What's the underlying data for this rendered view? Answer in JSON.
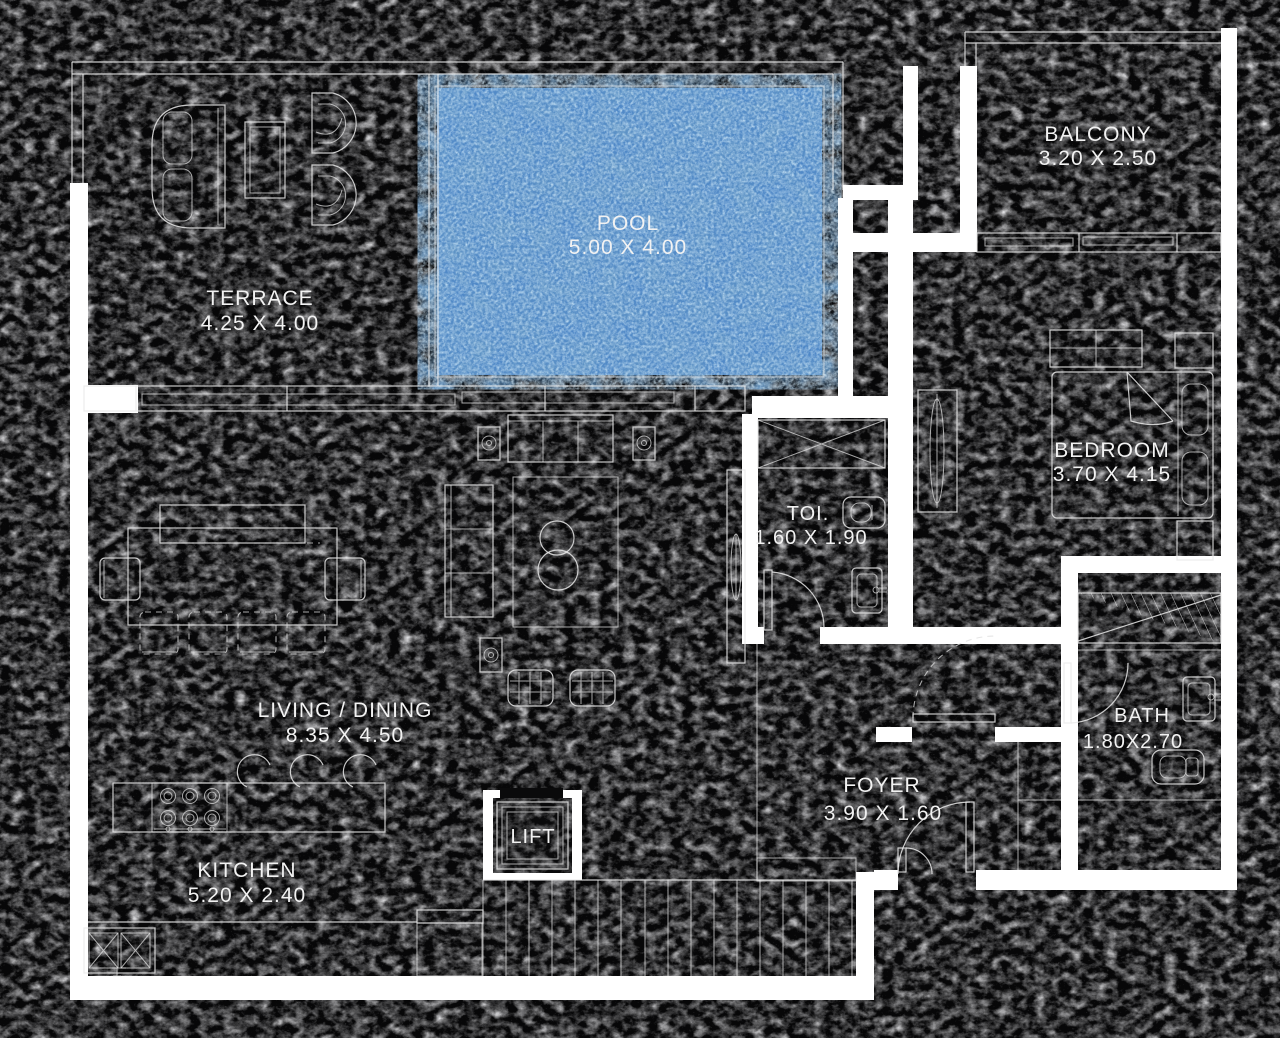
{
  "plan": {
    "rooms": {
      "terrace": {
        "name": "TERRACE",
        "dims": "4.25 X 4.00"
      },
      "pool": {
        "name": "POOL",
        "dims": "5.00 X 4.00"
      },
      "balcony": {
        "name": "BALCONY",
        "dims": "3.20 X 2.50"
      },
      "bedroom": {
        "name": "BEDROOM",
        "dims": "3.70 X 4.15"
      },
      "toilet": {
        "name": "TOI.",
        "dims": "1.60 X 1.90"
      },
      "living_dining": {
        "name": "LIVING / DINING",
        "dims": "8.35 X 4.50"
      },
      "bath": {
        "name": "BATH",
        "dims": "1.80X2.70"
      },
      "foyer": {
        "name": "FOYER",
        "dims": "3.90 X 1.60"
      },
      "kitchen": {
        "name": "KITCHEN",
        "dims": "5.20 X 2.40"
      },
      "lift": {
        "name": "LIFT"
      }
    },
    "colors": {
      "background": "#070708",
      "leather_highlight": "#c9c9cc",
      "wall": "#ffffff",
      "linework": "#e9e9e9",
      "pool_water": "#4f88c7",
      "pool_deep": "#1e4c8f",
      "label_text": "#f2f2f2"
    }
  }
}
